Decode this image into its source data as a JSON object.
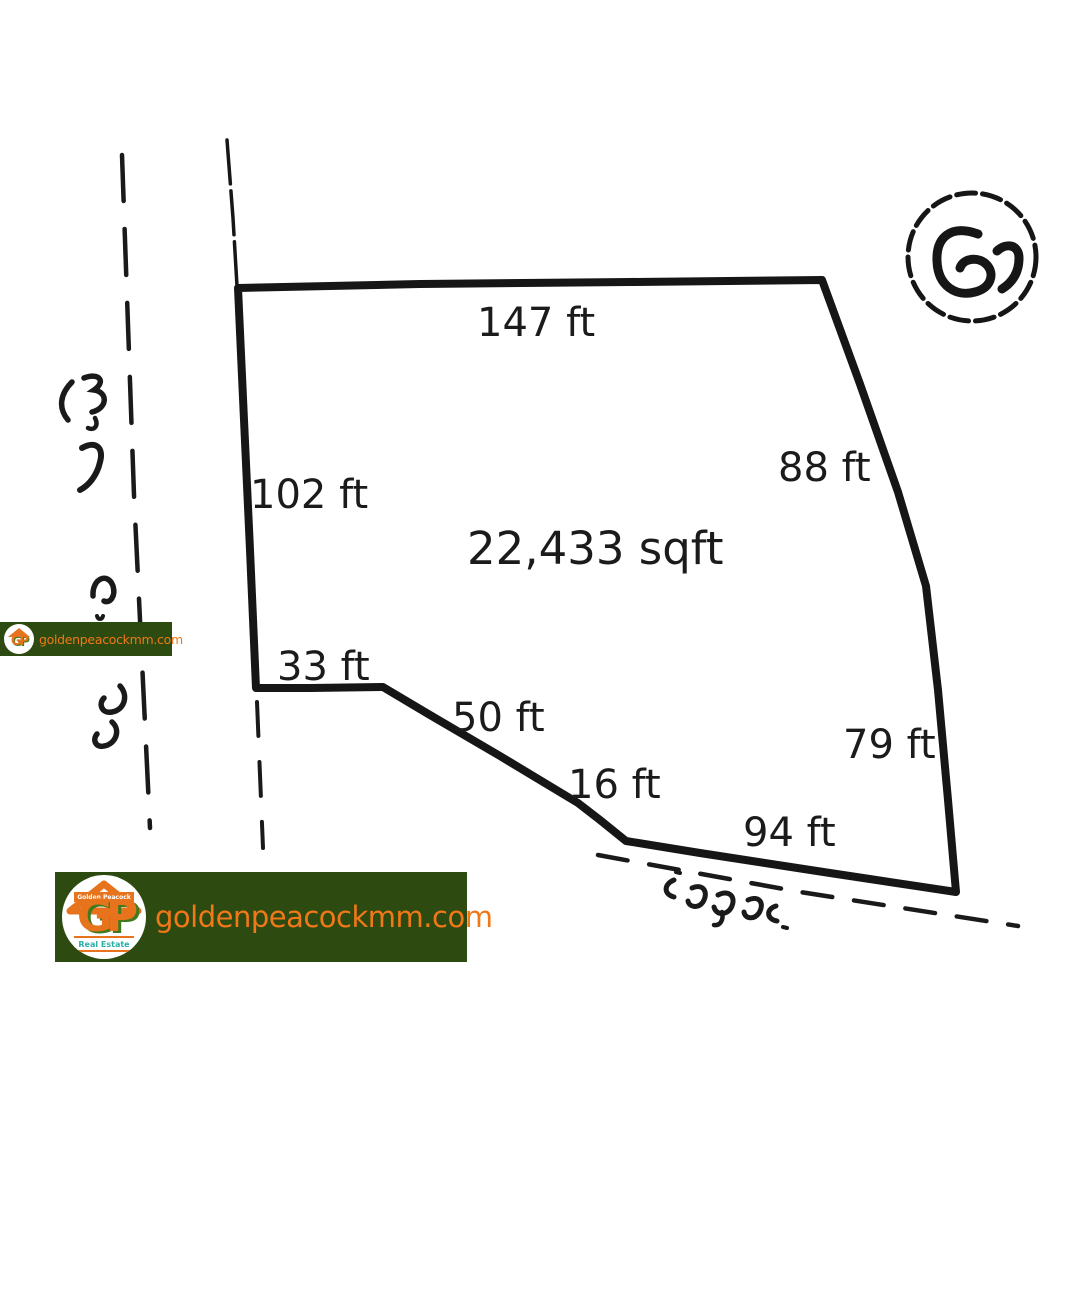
{
  "survey": {
    "area_label": "22,433 sqft",
    "sides": {
      "top": "147 ft",
      "left": "102 ft",
      "right_upper": "88 ft",
      "right_lower": "79 ft",
      "inner_bottom": "33 ft",
      "slope_long": "50 ft",
      "slope_short": "16 ft",
      "bottom": "94 ft"
    },
    "circle_mark": "၉၂",
    "handwriting": {
      "left_annotation": "burmese-handwritten-road-name",
      "bottom_annotation": "burmese-handwritten-road-name",
      "circle_annotation": "burmese-handwritten-plot-number"
    },
    "ink_color": "#161616"
  },
  "watermark": {
    "site": "goldenpeacockmm.com",
    "brand": "Golden Peacock",
    "tagline": "Real Estate",
    "initials": "GP",
    "bg_color": "#2d4a10",
    "url_color": "#f07818",
    "logo_orange": "#e8731d",
    "tagline_color": "#27b0a8"
  }
}
